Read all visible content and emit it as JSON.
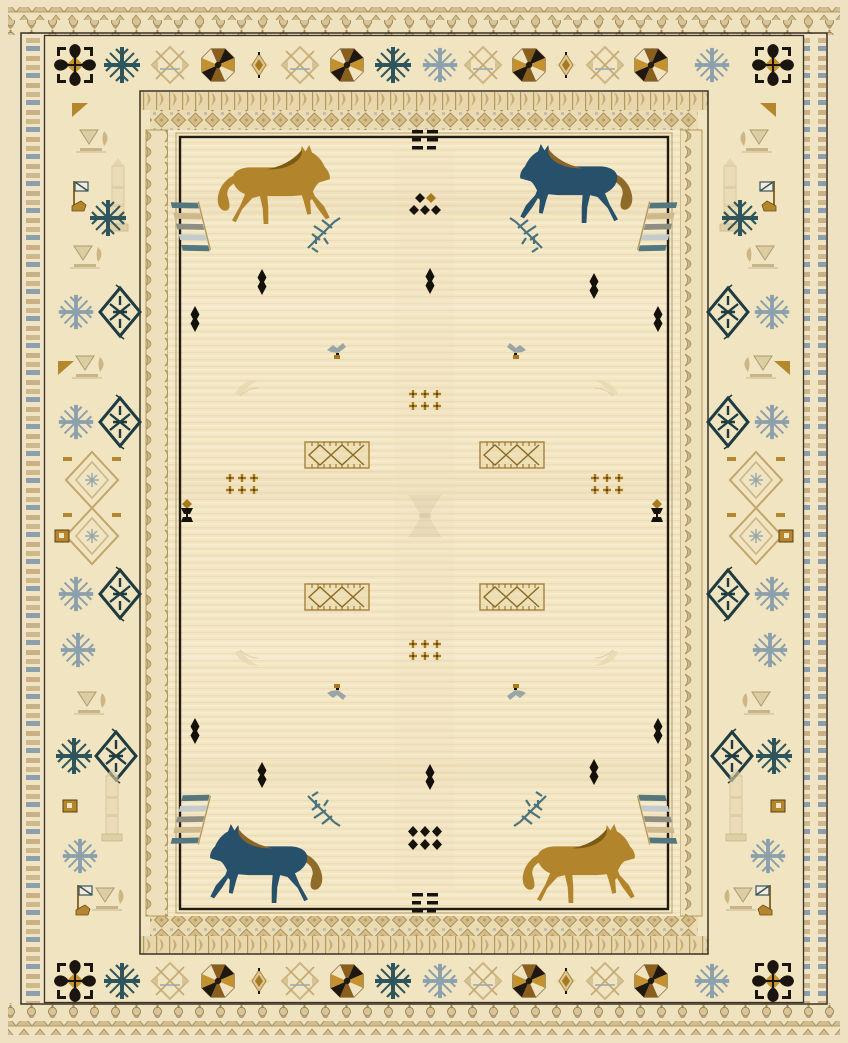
{
  "image": {
    "description": "Cream kilim-style area rug with four horse motifs (two gold, two navy-blue) in the field, small tribal geometric ornaments, and layered borders of snowflake rosettes, diamonds and tick bands",
    "width": 848,
    "height": 1043
  },
  "palette": {
    "field": "#f3e6c3",
    "cream": "#efe2c2",
    "border_bg": "#f1e4c1",
    "outline_black": "#1a150f",
    "gold": "#b5872c",
    "gold_dark": "#7c5a14",
    "bronze": "#a87a1e",
    "brown": "#6b4a1a",
    "navy": "#27506b",
    "teal": "#2e555c",
    "teal_dark": "#1e3c42",
    "teal_soft": "#4a737c",
    "slate": "#8ba0ac",
    "tan": "#cdb584",
    "tan_light": "#e6d8b2",
    "ink": "#16120c"
  },
  "horses": [
    {
      "id": "top-left",
      "x": 272,
      "y": 185,
      "facing": "right",
      "body": "#b2842b",
      "mane": "#7c5a14",
      "tail": "#b2842b"
    },
    {
      "id": "top-right",
      "x": 578,
      "y": 184,
      "facing": "left",
      "body": "#27506b",
      "mane": "#8a6428",
      "tail": "#8f6b2a"
    },
    {
      "id": "bottom-left",
      "x": 268,
      "y": 864,
      "facing": "left",
      "body": "#27506b",
      "mane": "#8a6428",
      "tail": "#8f6b2a"
    },
    {
      "id": "bottom-right",
      "x": 577,
      "y": 864,
      "facing": "right",
      "body": "#b2842b",
      "mane": "#7c5a14",
      "tail": "#b2842b"
    }
  ],
  "border": {
    "top_row": {
      "y": 65,
      "motifs": [
        {
          "x": 75,
          "t": "rosette-black"
        },
        {
          "x": 122,
          "t": "snowflake-teal"
        },
        {
          "x": 170,
          "t": "star-tan"
        },
        {
          "x": 218,
          "t": "rosette-gold"
        },
        {
          "x": 259,
          "t": "bud-gold"
        },
        {
          "x": 300,
          "t": "star-tan"
        },
        {
          "x": 347,
          "t": "rosette-gold"
        },
        {
          "x": 393,
          "t": "snowflake-teal"
        },
        {
          "x": 440,
          "t": "snowflake-slate"
        },
        {
          "x": 483,
          "t": "star-tan"
        },
        {
          "x": 529,
          "t": "rosette-gold"
        },
        {
          "x": 566,
          "t": "bud-gold"
        },
        {
          "x": 605,
          "t": "star-tan"
        },
        {
          "x": 651,
          "t": "rosette-gold"
        },
        {
          "x": 712,
          "t": "snowflake-slate"
        },
        {
          "x": 773,
          "t": "rosette-black"
        }
      ]
    },
    "bottom_row": {
      "y": 981,
      "motifs": [
        {
          "x": 75,
          "t": "rosette-black"
        },
        {
          "x": 122,
          "t": "snowflake-teal"
        },
        {
          "x": 170,
          "t": "star-tan"
        },
        {
          "x": 218,
          "t": "rosette-gold"
        },
        {
          "x": 259,
          "t": "bud-gold"
        },
        {
          "x": 300,
          "t": "star-tan"
        },
        {
          "x": 347,
          "t": "rosette-gold"
        },
        {
          "x": 393,
          "t": "snowflake-teal"
        },
        {
          "x": 440,
          "t": "snowflake-slate"
        },
        {
          "x": 483,
          "t": "star-tan"
        },
        {
          "x": 529,
          "t": "rosette-gold"
        },
        {
          "x": 566,
          "t": "bud-gold"
        },
        {
          "x": 605,
          "t": "star-tan"
        },
        {
          "x": 651,
          "t": "rosette-gold"
        },
        {
          "x": 712,
          "t": "snowflake-slate"
        },
        {
          "x": 773,
          "t": "rosette-black"
        }
      ]
    },
    "left_col": {
      "x": 92,
      "mirror": false,
      "rows": [
        {
          "y": 110,
          "items": [
            {
              "t": "tri-gold",
              "dx": -12
            }
          ]
        },
        {
          "y": 142,
          "items": [
            {
              "t": "arrowset",
              "dx": 2
            }
          ]
        },
        {
          "y": 196,
          "items": [
            {
              "t": "flag",
              "dx": -12
            },
            {
              "t": "obelisk",
              "dx": 26
            }
          ]
        },
        {
          "y": 218,
          "items": [
            {
              "t": "snowflake-teal",
              "dx": 16
            }
          ]
        },
        {
          "y": 258,
          "items": [
            {
              "t": "arrowset",
              "dx": -4
            }
          ]
        },
        {
          "y": 312,
          "items": [
            {
              "t": "snowflake-slate",
              "dx": -16
            },
            {
              "t": "diamond-teal",
              "dx": 28
            }
          ]
        },
        {
          "y": 368,
          "items": [
            {
              "t": "arrowset",
              "dx": -2
            },
            {
              "t": "tri-gold",
              "dx": -26
            }
          ]
        },
        {
          "y": 422,
          "items": [
            {
              "t": "snowflake-slate",
              "dx": -16
            },
            {
              "t": "diamond-teal",
              "dx": 28
            }
          ]
        },
        {
          "y": 480,
          "items": [
            {
              "t": "chevron",
              "dx": 0
            }
          ]
        },
        {
          "y": 536,
          "items": [
            {
              "t": "chevron",
              "dx": 0
            },
            {
              "t": "sq-gold",
              "dx": -30
            }
          ]
        },
        {
          "y": 594,
          "items": [
            {
              "t": "snowflake-slate",
              "dx": -16
            },
            {
              "t": "diamond-teal",
              "dx": 28
            }
          ]
        },
        {
          "y": 650,
          "items": [
            {
              "t": "snowflake-slate",
              "dx": -14
            }
          ]
        },
        {
          "y": 704,
          "items": [
            {
              "t": "arrowset",
              "dx": 0
            }
          ]
        },
        {
          "y": 756,
          "items": [
            {
              "t": "snowflake-teal",
              "dx": -18
            },
            {
              "t": "diamond-teal",
              "dx": 24
            }
          ]
        },
        {
          "y": 806,
          "items": [
            {
              "t": "obelisk",
              "dx": 20
            },
            {
              "t": "sq-gold",
              "dx": -22
            }
          ]
        },
        {
          "y": 856,
          "items": [
            {
              "t": "snowflake-slate",
              "dx": -12
            }
          ]
        },
        {
          "y": 900,
          "items": [
            {
              "t": "flag",
              "dx": -8
            },
            {
              "t": "arrowset",
              "dx": 18
            }
          ]
        }
      ]
    },
    "right_col": {
      "x": 756,
      "mirror": true,
      "rows": [
        {
          "y": 110,
          "items": [
            {
              "t": "tri-gold",
              "dx": -12
            }
          ]
        },
        {
          "y": 142,
          "items": [
            {
              "t": "arrowset",
              "dx": 2
            }
          ]
        },
        {
          "y": 196,
          "items": [
            {
              "t": "flag",
              "dx": -12
            },
            {
              "t": "obelisk",
              "dx": 26
            }
          ]
        },
        {
          "y": 218,
          "items": [
            {
              "t": "snowflake-teal",
              "dx": 16
            }
          ]
        },
        {
          "y": 258,
          "items": [
            {
              "t": "arrowset",
              "dx": -4
            }
          ]
        },
        {
          "y": 312,
          "items": [
            {
              "t": "snowflake-slate",
              "dx": -16
            },
            {
              "t": "diamond-teal",
              "dx": 28
            }
          ]
        },
        {
          "y": 368,
          "items": [
            {
              "t": "arrowset",
              "dx": -2
            },
            {
              "t": "tri-gold",
              "dx": -26
            }
          ]
        },
        {
          "y": 422,
          "items": [
            {
              "t": "snowflake-slate",
              "dx": -16
            },
            {
              "t": "diamond-teal",
              "dx": 28
            }
          ]
        },
        {
          "y": 480,
          "items": [
            {
              "t": "chevron",
              "dx": 0
            }
          ]
        },
        {
          "y": 536,
          "items": [
            {
              "t": "chevron",
              "dx": 0
            },
            {
              "t": "sq-gold",
              "dx": -30
            }
          ]
        },
        {
          "y": 594,
          "items": [
            {
              "t": "snowflake-slate",
              "dx": -16
            },
            {
              "t": "diamond-teal",
              "dx": 28
            }
          ]
        },
        {
          "y": 650,
          "items": [
            {
              "t": "snowflake-slate",
              "dx": -14
            }
          ]
        },
        {
          "y": 704,
          "items": [
            {
              "t": "arrowset",
              "dx": 0
            }
          ]
        },
        {
          "y": 756,
          "items": [
            {
              "t": "snowflake-teal",
              "dx": -18
            },
            {
              "t": "diamond-teal",
              "dx": 24
            }
          ]
        },
        {
          "y": 806,
          "items": [
            {
              "t": "obelisk",
              "dx": 20
            },
            {
              "t": "sq-gold",
              "dx": -22
            }
          ]
        },
        {
          "y": 856,
          "items": [
            {
              "t": "snowflake-slate",
              "dx": -12
            }
          ]
        },
        {
          "y": 900,
          "items": [
            {
              "t": "flag",
              "dx": -8
            },
            {
              "t": "arrowset",
              "dx": 18
            }
          ]
        }
      ]
    }
  },
  "field_motifs": [
    {
      "t": "bars",
      "x": 425,
      "y": 140
    },
    {
      "t": "dia2",
      "x": 425,
      "y": 204
    },
    {
      "t": "wing",
      "x": 191,
      "y": 226
    },
    {
      "t": "wing",
      "x": 657,
      "y": 226,
      "fx": -1
    },
    {
      "t": "branch",
      "x": 322,
      "y": 234
    },
    {
      "t": "branch",
      "x": 528,
      "y": 234,
      "fx": -1
    },
    {
      "t": "lozenge",
      "x": 262,
      "y": 282
    },
    {
      "t": "lozenge",
      "x": 430,
      "y": 281
    },
    {
      "t": "lozenge",
      "x": 594,
      "y": 286
    },
    {
      "t": "lozenge",
      "x": 195,
      "y": 319
    },
    {
      "t": "lozenge",
      "x": 658,
      "y": 319
    },
    {
      "t": "bird",
      "x": 337,
      "y": 351
    },
    {
      "t": "bird",
      "x": 516,
      "y": 351,
      "fx": -1
    },
    {
      "t": "paleleaf",
      "x": 247,
      "y": 387
    },
    {
      "t": "paleleaf",
      "x": 606,
      "y": 387,
      "fx": -1
    },
    {
      "t": "cluster",
      "x": 425,
      "y": 400
    },
    {
      "t": "lattice",
      "x": 337,
      "y": 455
    },
    {
      "t": "lattice",
      "x": 512,
      "y": 455
    },
    {
      "t": "cluster",
      "x": 242,
      "y": 484
    },
    {
      "t": "cluster",
      "x": 607,
      "y": 484
    },
    {
      "t": "goblet",
      "x": 187,
      "y": 511
    },
    {
      "t": "goblet",
      "x": 657,
      "y": 511
    },
    {
      "t": "hourglass",
      "x": 425,
      "y": 516
    },
    {
      "t": "lattice",
      "x": 337,
      "y": 597
    },
    {
      "t": "lattice",
      "x": 512,
      "y": 597
    },
    {
      "t": "cluster",
      "x": 425,
      "y": 650
    },
    {
      "t": "paleleaf",
      "x": 247,
      "y": 659,
      "fy": -1
    },
    {
      "t": "paleleaf",
      "x": 606,
      "y": 659,
      "fx": -1,
      "fy": -1
    },
    {
      "t": "bird",
      "x": 337,
      "y": 692,
      "fy": -1
    },
    {
      "t": "bird",
      "x": 516,
      "y": 692,
      "fx": -1,
      "fy": -1
    },
    {
      "t": "lozenge",
      "x": 195,
      "y": 731
    },
    {
      "t": "lozenge",
      "x": 658,
      "y": 731
    },
    {
      "t": "lozenge",
      "x": 262,
      "y": 775
    },
    {
      "t": "lozenge",
      "x": 430,
      "y": 777
    },
    {
      "t": "lozenge",
      "x": 594,
      "y": 772
    },
    {
      "t": "branch",
      "x": 322,
      "y": 810,
      "fy": -1
    },
    {
      "t": "branch",
      "x": 532,
      "y": 810,
      "fx": -1,
      "fy": -1
    },
    {
      "t": "wing",
      "x": 191,
      "y": 820,
      "fy": -1
    },
    {
      "t": "wing",
      "x": 657,
      "y": 820,
      "fx": -1,
      "fy": -1
    },
    {
      "t": "dia32",
      "x": 425,
      "y": 838
    },
    {
      "t": "bars",
      "x": 425,
      "y": 903
    }
  ]
}
